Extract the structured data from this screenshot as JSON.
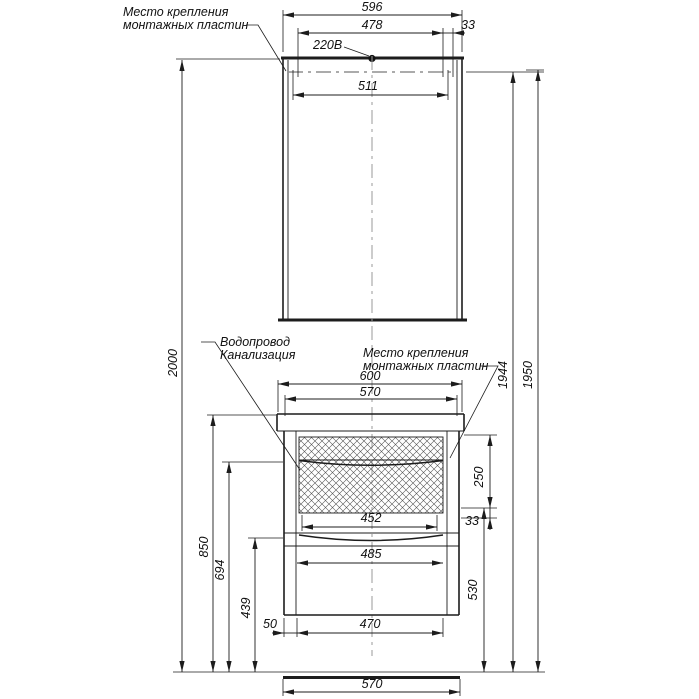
{
  "drawing": {
    "labels": {
      "mirror_plate_1": "Место крепления",
      "mirror_plate_2": "монтажных пластин",
      "power": "220В",
      "plumbing_1": "Водопровод",
      "plumbing_2": "Канализация",
      "vanity_plate_1": "Место крепления",
      "vanity_plate_2": "монтажных пластин"
    },
    "dimensions": {
      "mirror_width": "596",
      "plate_span": "478",
      "plate_width_top": "33",
      "plate_centers": "511",
      "total_height": "2000",
      "mounting_height_inner": "1944",
      "mounting_height_outer": "1950",
      "counter_width": "600",
      "cabinet_width_top": "570",
      "counter_height": "850",
      "handle1_height": "694",
      "handle2_height": "439",
      "drawer_front_height": "250",
      "rail_gap": "33",
      "drawer_opening_width": "452",
      "drawer_width": "485",
      "rail_height": "530",
      "left_offset": "50",
      "inner_width": "470",
      "cabinet_width_bottom": "570"
    }
  }
}
